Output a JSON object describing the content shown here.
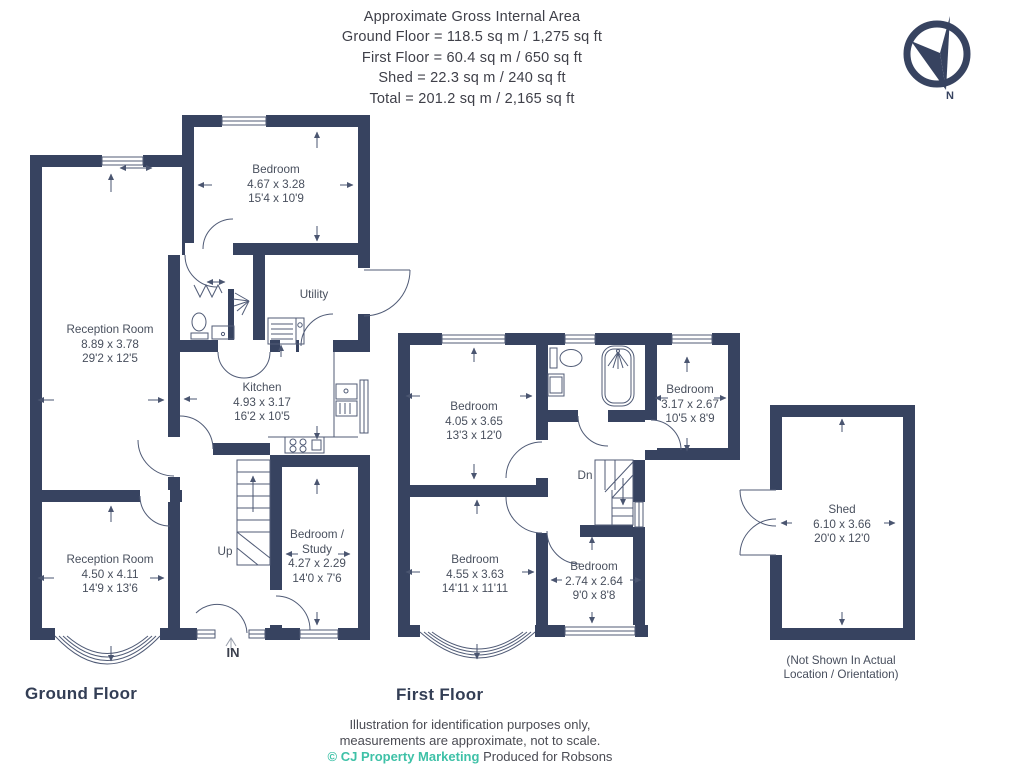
{
  "header": {
    "lines": [
      "Approximate Gross Internal Area",
      "Ground Floor = 118.5 sq m / 1,275 sq ft",
      "First Floor = 60.4 sq m / 650 sq ft",
      "Shed = 22.3 sq m / 240 sq ft",
      "Total = 201.2 sq m / 2,165 sq ft"
    ]
  },
  "compass": {
    "label": "N"
  },
  "ground_floor": {
    "label": "Ground Floor",
    "rooms": {
      "bedroom": {
        "name": "Bedroom",
        "metric": "4.67 x 3.28",
        "imperial": "15'4 x 10'9"
      },
      "reception_top": {
        "name": "Reception Room",
        "metric": "8.89 x 3.78",
        "imperial": "29'2 x 12'5"
      },
      "utility": {
        "name": "Utility"
      },
      "kitchen": {
        "name": "Kitchen",
        "metric": "4.93 x 3.17",
        "imperial": "16'2 x 10'5"
      },
      "reception_bottom": {
        "name": "Reception Room",
        "metric": "4.50 x 4.11",
        "imperial": "14'9 x 13'6"
      },
      "study": {
        "name": "Bedroom / Study",
        "metric": "4.27 x 2.29",
        "imperial": "14'0 x 7'6"
      }
    },
    "stairs_label": "Up",
    "entrance_label": "IN"
  },
  "first_floor": {
    "label": "First Floor",
    "rooms": {
      "bedroom_top_left": {
        "name": "Bedroom",
        "metric": "4.05 x 3.65",
        "imperial": "13'3 x 12'0"
      },
      "bedroom_top_right": {
        "name": "Bedroom",
        "metric": "3.17 x 2.67",
        "imperial": "10'5 x 8'9"
      },
      "bedroom_bottom_left": {
        "name": "Bedroom",
        "metric": "4.55 x 3.63",
        "imperial": "14'11 x 11'11"
      },
      "bedroom_bottom_right": {
        "name": "Bedroom",
        "metric": "2.74 x 2.64",
        "imperial": "9'0 x 8'8"
      }
    },
    "stairs_label": "Dn"
  },
  "shed": {
    "name": "Shed",
    "metric": "6.10 x 3.66",
    "imperial": "20'0 x 12'0",
    "note": [
      "(Not Shown In Actual",
      "Location / Orientation)"
    ]
  },
  "footer": {
    "disclaimer": [
      "Illustration for identification purposes only,",
      "measurements are approximate, not to scale."
    ],
    "credit_brand": "© CJ Property Marketing",
    "credit_text": "Produced for Robsons"
  },
  "colors": {
    "wall": "#374360",
    "accent_teal": "#3ec1a7"
  }
}
